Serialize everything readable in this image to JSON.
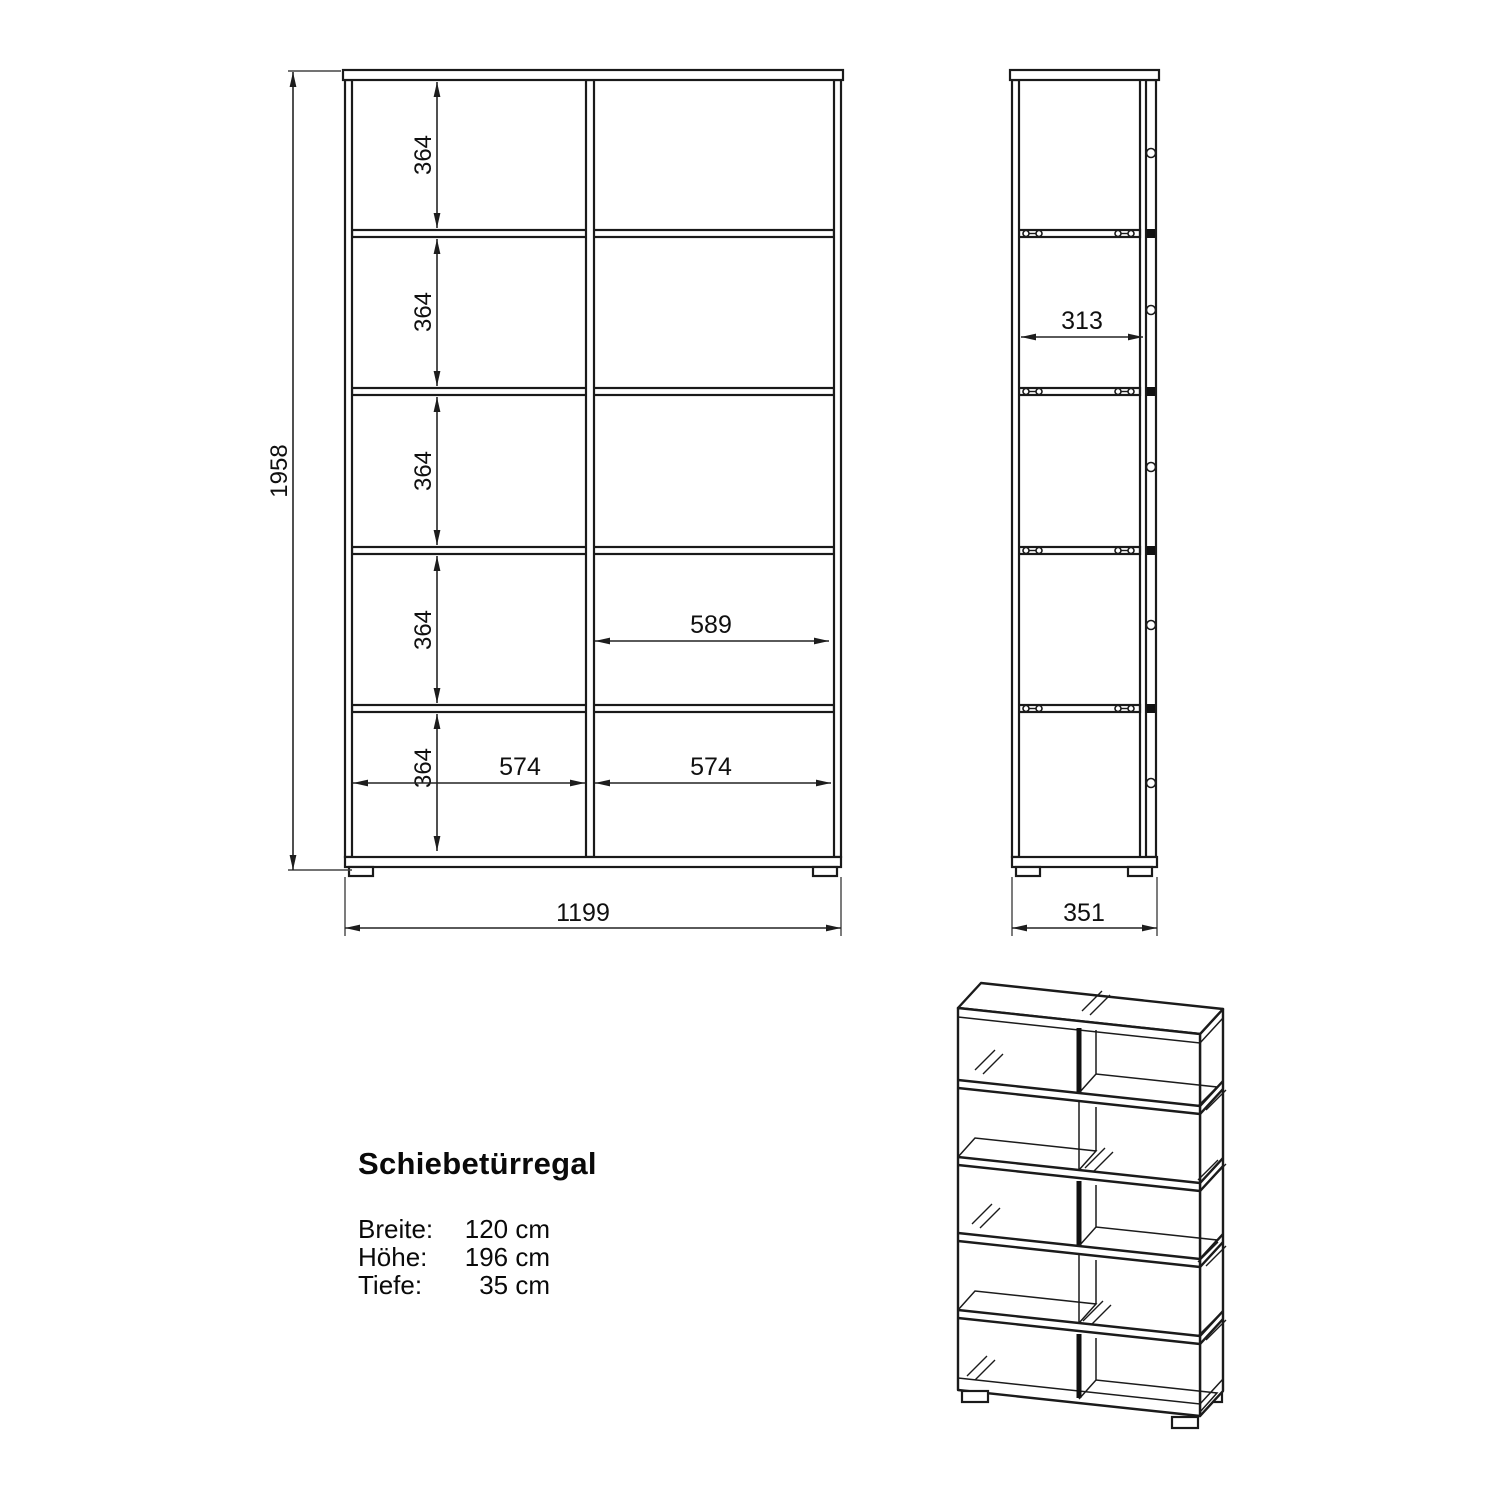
{
  "product": {
    "name": "Schiebetürregal",
    "specs": [
      {
        "label": "Breite:",
        "value": "120 cm"
      },
      {
        "label": "Höhe:",
        "value": "196 cm"
      },
      {
        "label": "Tiefe:",
        "value": "35 cm"
      }
    ]
  },
  "front_view": {
    "height_total": "1958",
    "width_total": "1199",
    "compartment_heights": [
      "364",
      "364",
      "364",
      "364",
      "364"
    ],
    "door_overlap_width": "589",
    "compartment_widths": [
      "574",
      "574"
    ]
  },
  "side_view": {
    "depth_inner": "313",
    "depth_total": "351"
  }
}
